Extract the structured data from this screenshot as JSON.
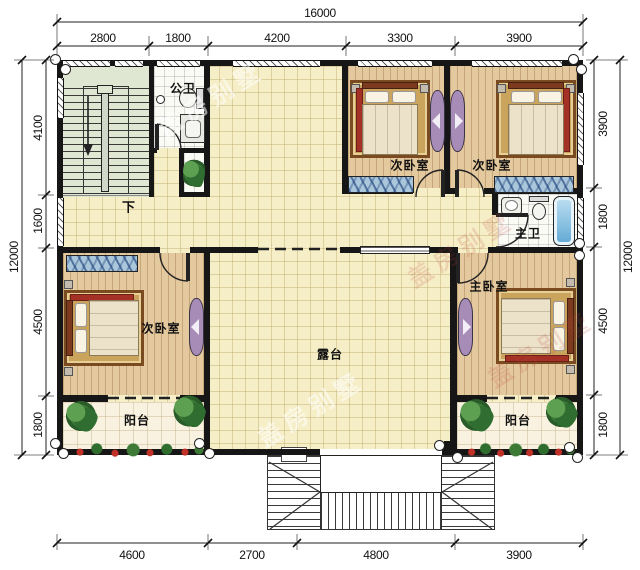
{
  "rooms": {
    "stairs_down": "下",
    "public_bath": "公卫",
    "bedroom_top_left": "次卧室",
    "bedroom_top_right": "次卧室",
    "master_bath": "主卫",
    "master_bedroom": "主卧室",
    "bedroom_west": "次卧室",
    "terrace": "露台",
    "balcony_left": "阳台",
    "balcony_right": "阳台"
  },
  "dimensions": {
    "top_total": "16000",
    "top": [
      "2800",
      "1800",
      "4200",
      "3300",
      "3900"
    ],
    "left_total": "12000",
    "left": [
      "4100",
      "1600",
      "4500",
      "1800"
    ],
    "right": [
      "3900",
      "1800",
      "4500",
      "1800"
    ],
    "right_total": "12000",
    "bottom": [
      "4600",
      "2700",
      "4800",
      "3900"
    ]
  },
  "watermark": {
    "text": "盖房别墅"
  },
  "colors": {
    "wall": "#161616",
    "tile": "#f6eec6",
    "wood": "#e4c89e",
    "bath": "#fbfbf6",
    "stair": "#dfe7d3",
    "balcony": "#f9f2e0",
    "wardrobe": "#a9c6da",
    "dresser": "#a88cb8",
    "tub": "#5fa8d4",
    "bedred": "#a33126",
    "flower": "#c23127",
    "plantgreen": "#3c7a36"
  }
}
